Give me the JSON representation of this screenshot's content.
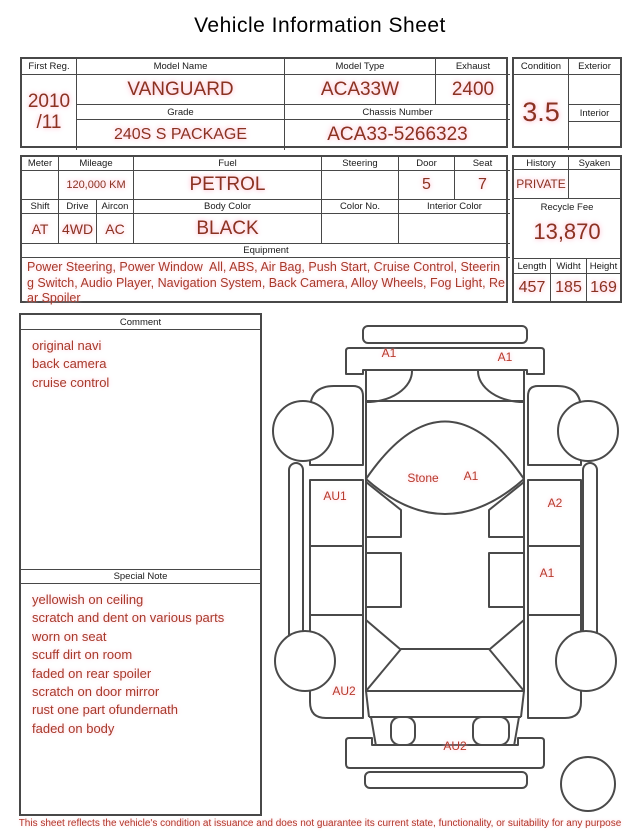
{
  "title": "Vehicle Information Sheet",
  "section1": {
    "first_reg": {
      "label": "First Reg.",
      "value": "2010\n/11"
    },
    "model_name": {
      "label": "Model Name",
      "value": "VANGUARD"
    },
    "model_type": {
      "label": "Model Type",
      "value": "ACA33W"
    },
    "exhaust": {
      "label": "Exhaust",
      "value": "2400"
    },
    "grade": {
      "label": "Grade",
      "value": "240S S PACKAGE"
    },
    "chassis_number": {
      "label": "Chassis Number",
      "value": "ACA33-5266323"
    },
    "condition": {
      "label": "Condition",
      "value": "3.5"
    },
    "exterior": {
      "label": "Exterior",
      "value": ""
    },
    "interior": {
      "label": "Interior",
      "value": ""
    }
  },
  "section2": {
    "meter": {
      "label": "Meter",
      "value": ""
    },
    "mileage": {
      "label": "Mileage",
      "value": "120,000 KM"
    },
    "fuel": {
      "label": "Fuel",
      "value": "PETROL"
    },
    "steering": {
      "label": "Steering",
      "value": ""
    },
    "door": {
      "label": "Door",
      "value": "5"
    },
    "seat": {
      "label": "Seat",
      "value": "7"
    },
    "shift": {
      "label": "Shift",
      "value": "AT"
    },
    "drive": {
      "label": "Drive",
      "value": "4WD"
    },
    "aircon": {
      "label": "Aircon",
      "value": "AC"
    },
    "body_color": {
      "label": "Body Color",
      "value": "BLACK"
    },
    "color_no": {
      "label": "Color No.",
      "value": ""
    },
    "interior_color": {
      "label": "Interior Color",
      "value": ""
    },
    "history": {
      "label": "History",
      "value": "PRIVATE"
    },
    "syaken": {
      "label": "Syaken",
      "value": ""
    },
    "recycle_fee": {
      "label": "Recycle Fee",
      "value": "13,870"
    },
    "length": {
      "label": "Length",
      "value": "457"
    },
    "width": {
      "label": "Widht",
      "value": "185"
    },
    "height": {
      "label": "Height",
      "value": "169"
    },
    "equipment": {
      "label": "Equipment",
      "text": "Power Steering, Power Window  All, ABS, Air Bag, Push Start, Cruise Control, Steering Switch, Audio Player, Navigation System, Back Camera, Alloy Wheels, Fog Light, Rear Spoiler"
    }
  },
  "comment": {
    "label": "Comment",
    "lines": [
      "original navi",
      "back camera",
      "cruise control"
    ]
  },
  "special_note": {
    "label": "Special Note",
    "lines": [
      "yellowish on ceiling",
      "scratch and dent on various parts",
      "worn on seat",
      "scuff dirt on room",
      "faded on rear spoiler",
      "scratch on door mirror",
      "rust one part ofundernath",
      "faded on body"
    ]
  },
  "diagram": {
    "labels": {
      "front_left": "A1",
      "front_right": "A1",
      "windshield_stone": "Stone",
      "windshield": "A1",
      "left_front_door": "AU1",
      "right_front_door": "A2",
      "right_rear_door": "A1",
      "left_rear_fender": "AU2",
      "rear_bumper": "AU2"
    }
  },
  "footer": "This sheet reflects the vehicle's condition at issuance and does not guarantee its current state, functionality, or suitability for any purpose",
  "colors": {
    "value_red": "#8b3222",
    "note_red": "#a8392a",
    "diagram_label_red": "#b8392b",
    "highlight_pink": "#ffbfd0",
    "line_gray": "#484848"
  }
}
